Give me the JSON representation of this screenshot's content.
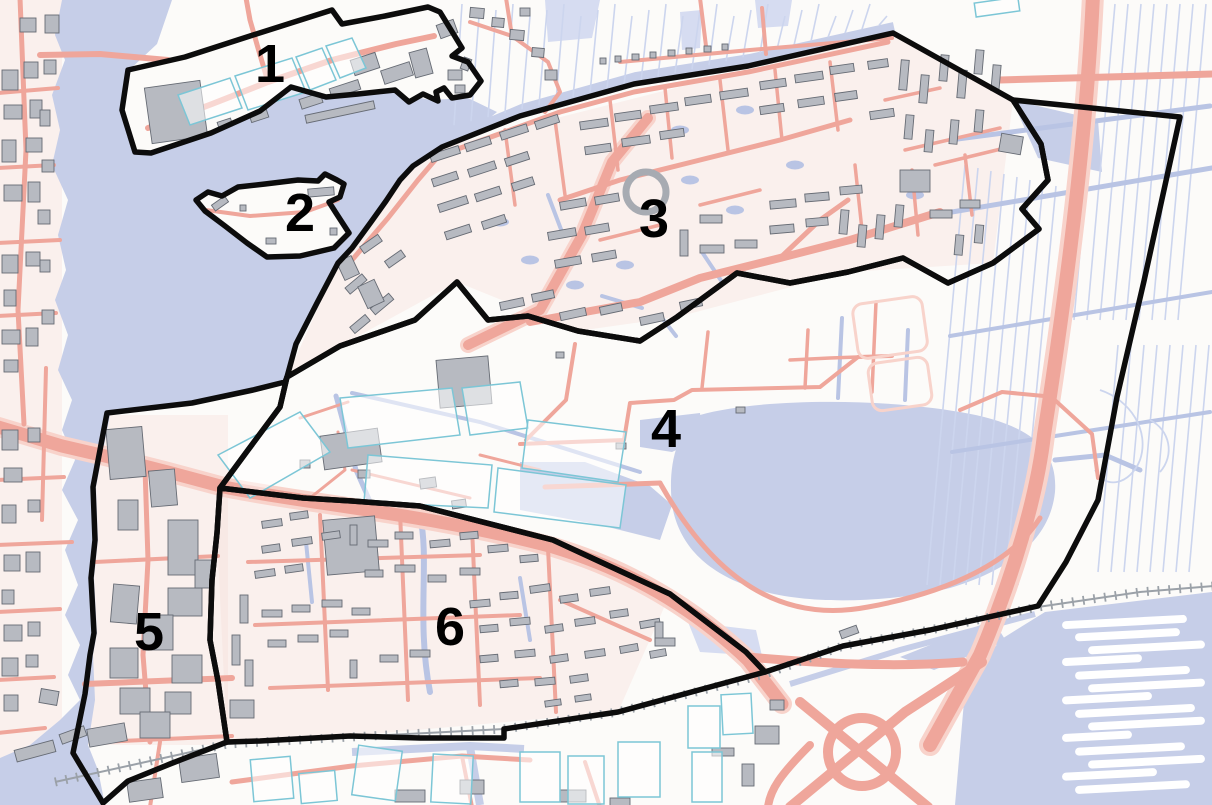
{
  "map": {
    "districts": [
      {
        "id": "1",
        "label": "1",
        "label_x": 270,
        "label_y": 64,
        "points": "122,110 128,70 185,57 250,36 332,10 342,24 385,16 428,7 440,12 462,48 452,56 468,62 481,81 470,95 452,98 444,88 436,92 438,101 423,94 409,102 395,90 358,94 326,97 291,87 260,111 211,133 151,153 135,152"
      },
      {
        "id": "2",
        "label": "2",
        "label_x": 300,
        "label_y": 213,
        "points": "196,200 208,192 222,196 238,187 265,184 298,180 318,181 325,174 337,180 344,184 340,197 329,202 336,213 349,233 334,248 300,256 267,257 247,243 225,226 205,211"
      },
      {
        "id": "3",
        "label": "3",
        "label_x": 654,
        "label_y": 219,
        "points": "442,147 520,116 634,84 748,66 893,33 1013,100 1041,144 1048,180 1022,209 1039,229 993,263 948,283 903,258 848,272 790,283 737,273 677,317 640,341 578,331 528,316 488,320 457,282 415,320 340,346 287,377 296,344 317,303 338,263 352,248 371,222 386,201 400,180 413,166"
      },
      {
        "id": "4",
        "label": "4",
        "label_x": 666,
        "label_y": 429,
        "points": "287,377 340,346 415,320 457,282 488,320 528,316 578,331 640,341 677,317 737,273 790,283 848,272 903,258 948,283 993,263 1039,229 1022,209 1048,180 1041,144 1013,100 1180,117 1144,281 1117,397 1098,500 1066,562 1038,606 930,630 843,646 765,672 746,652 670,594 553,540 420,506 352,501 303,498 220,488 248,450 280,407"
      },
      {
        "id": "5",
        "label": "5",
        "label_x": 149,
        "label_y": 632,
        "points": "287,377 280,407 248,450 220,488 217,533 212,580 210,640 218,681 227,742 170,764 128,781 103,803 88,778 73,753 85,694 90,655 94,633 91,578 95,540 93,487 107,413 192,403 253,390 285,382"
      },
      {
        "id": "6",
        "label": "6",
        "label_x": 450,
        "label_y": 627,
        "points": "220,488 303,498 352,501 420,506 553,540 670,594 746,652 765,672 618,712 504,729 504,738 420,738 350,736 260,741 227,742 218,681 210,640 212,580 217,533"
      }
    ],
    "colors": {
      "land": "#fcfbf9",
      "water": "#c6cee8",
      "water_lt": "#d6dcf1",
      "ditch": "#b9c4e4",
      "ditch_lt": "#ccd5ee",
      "road": "#efa69b",
      "road_halo": "#f8d3cb",
      "building": "#b7bac1",
      "building_outline": "#666b74",
      "greenhouse": "#7cc6d6",
      "railway": "#9ba1a8",
      "boundary": "#0c0c0c",
      "label": "#000000",
      "tint": "#f6d9d2"
    }
  }
}
